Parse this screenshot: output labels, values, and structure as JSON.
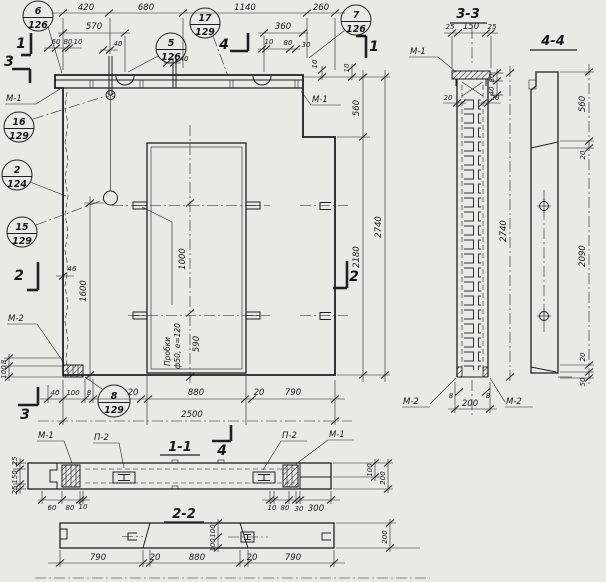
{
  "sections": {
    "s11": "1-1",
    "s22": "2-2",
    "s33": "3-3",
    "s44": "4-4"
  },
  "balloons": {
    "b6": {
      "num": "6",
      "sheet": "126"
    },
    "b17": {
      "num": "17",
      "sheet": "129"
    },
    "b5": {
      "num": "5",
      "sheet": "126"
    },
    "b7": {
      "num": "7",
      "sheet": "126"
    },
    "b16": {
      "num": "16",
      "sheet": "129"
    },
    "b2": {
      "num": "2",
      "sheet": "124"
    },
    "b15": {
      "num": "15",
      "sheet": "129"
    },
    "b8": {
      "num": "8",
      "sheet": "129"
    }
  },
  "labels": {
    "m1": "М-1",
    "m2": "М-2",
    "p2": "П-2"
  },
  "cuts": {
    "c1": "1",
    "c2": "2",
    "c3": "3",
    "c4": "4"
  },
  "note": {
    "line1": "Пробки",
    "line2": "ф50, е=120"
  },
  "dims": {
    "8": "8",
    "10": "10",
    "20": "20",
    "25": "25",
    "30": "30",
    "40": "40",
    "46": "46",
    "50": "50",
    "60": "60",
    "80": "80",
    "100": "100",
    "150": "150",
    "200": "200",
    "260": "260",
    "300": "300",
    "360": "360",
    "420": "420",
    "560": "560",
    "570": "570",
    "590": "590",
    "680": "680",
    "790": "790",
    "880": "880",
    "1000": "1000",
    "1140": "1140",
    "1600": "1600",
    "2090": "2090",
    "2180": "2180",
    "2500": "2500",
    "2740": "2740"
  }
}
